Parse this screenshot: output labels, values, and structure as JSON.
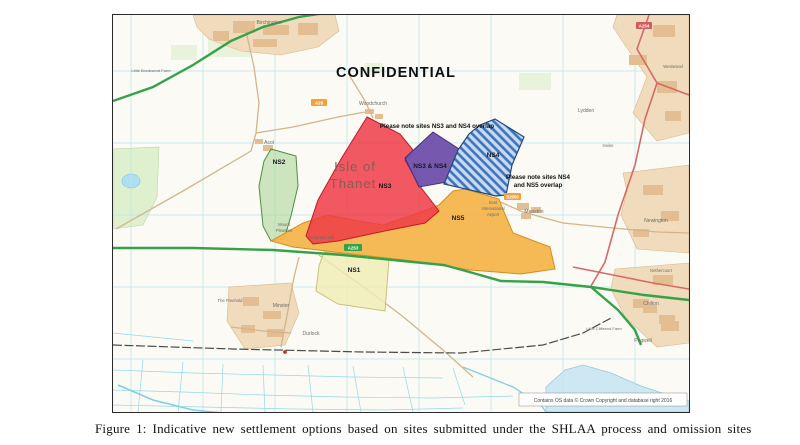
{
  "figure": {
    "caption": "Figure 1: Indicative new settlement options based on sites submitted under the SHLAA process and omission sites"
  },
  "map": {
    "watermark": "CONFIDENTIAL",
    "region": {
      "line1": "Isle of",
      "line2": "Thanet"
    },
    "annotations": {
      "ns3_ns4_overlap": "Please note sites NS3 and NS4 overlap",
      "ns4_ns5_overlap_line1": "Please note sites NS4",
      "ns4_ns5_overlap_line2": "and NS5 overlap"
    },
    "sites": {
      "ns1": {
        "label": "NS1",
        "color": "#F0EDB4"
      },
      "ns2": {
        "label": "NS2",
        "color": "#A8D494"
      },
      "ns3": {
        "label": "NS3",
        "color": "#EE3B46"
      },
      "ns3_ns4": {
        "label": "NS3 & NS4",
        "color": "#6A4BA8"
      },
      "ns4": {
        "label": "NS4",
        "color": "#3E72BC"
      },
      "ns5": {
        "label": "NS5",
        "color": "#F4B54D"
      }
    },
    "places": {
      "birchington": "Birchington",
      "woodchurch": "Woodchurch",
      "acol": "Acol",
      "lydden": "Lydden",
      "manston": "Manston",
      "airport_line1": "Kent",
      "airport_line2": "International",
      "airport_line3": "Airport",
      "minster": "Minster",
      "the_freehold": "The Freehold",
      "durlock": "Durlock",
      "mount_pleasant_line1": "Mount",
      "mount_pleasant_line2": "Pleasant",
      "telegraph_hill": "Telegraph Hill",
      "chilton": "Chilton",
      "pegwell": "Pegwell",
      "nethercourt": "Nethercourt",
      "newington": "Newington",
      "haine": "Haine",
      "westwood": "Westwood",
      "little_cliffsend_farm": "Little Cliffsend Farm",
      "little_brooksend_farm": "Little Brooksend Farm"
    },
    "road_badges": {
      "a28": "A28",
      "a253": "A253",
      "b2050": "B2050",
      "a254": "A254"
    },
    "copyright": "Contains OS data © Crown Copyright and database right 2016"
  }
}
